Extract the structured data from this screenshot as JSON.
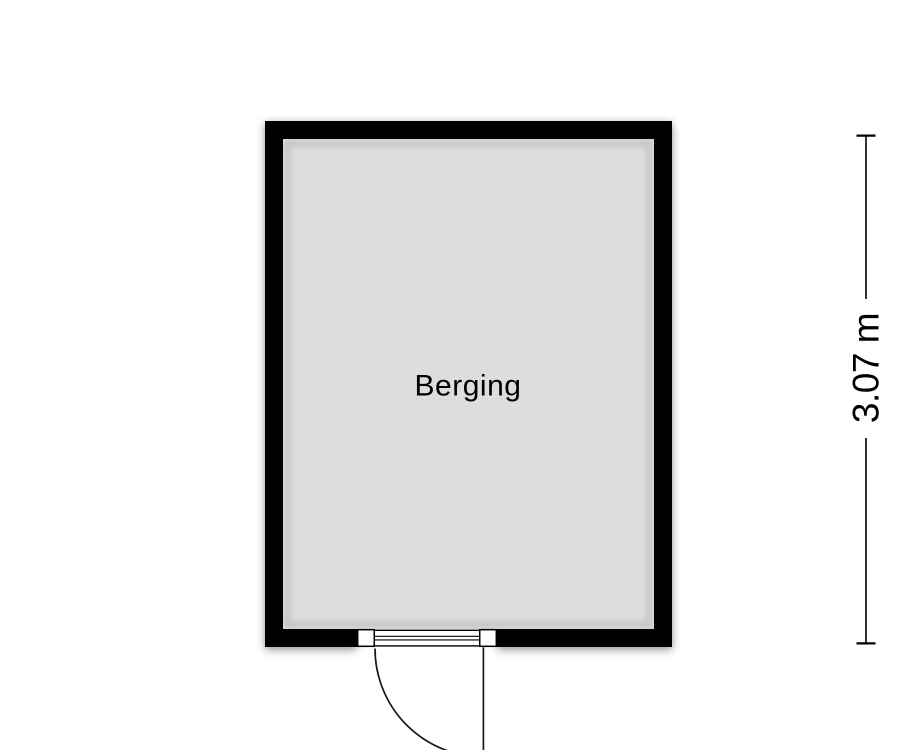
{
  "plan": {
    "room": {
      "name": "Berging"
    },
    "dimension_right": {
      "value": "3.07 m"
    },
    "door": {
      "style": "single-hinged",
      "swing": "outward-down",
      "hinge_side": "right"
    },
    "colors": {
      "wall": "#000000",
      "floor": "#dddddd",
      "background": "#ffffff",
      "line": "#1a1a1a",
      "threshold_fill": "#ffffff"
    }
  }
}
